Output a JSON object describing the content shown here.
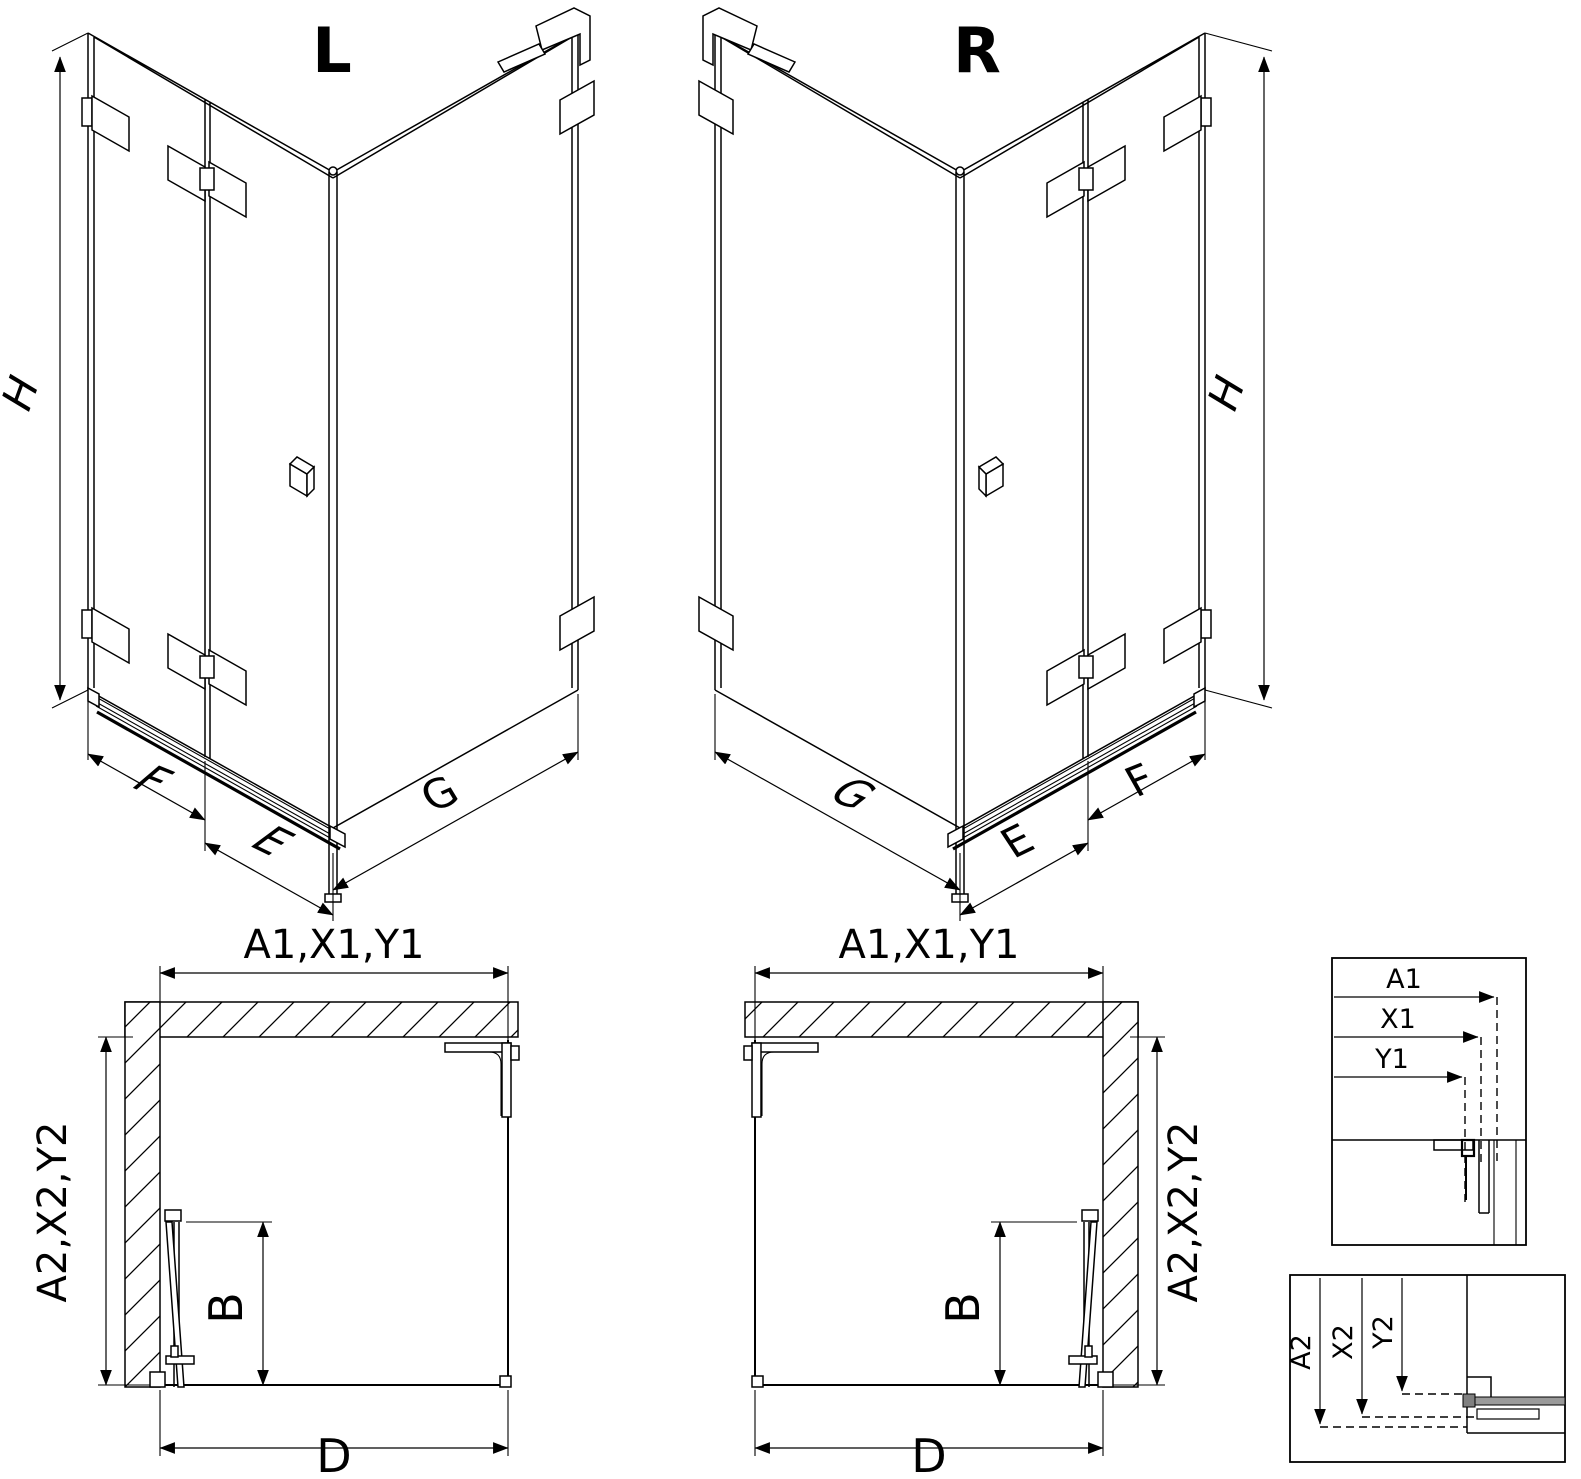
{
  "canvas": {
    "background": "#ffffff",
    "line_color": "#000000",
    "profile_gray": "#9a9a9a"
  },
  "iso_left": {
    "title": "L",
    "dim_height": "H",
    "dim_fixed": "F",
    "dim_door": "E",
    "dim_side": "G"
  },
  "iso_right": {
    "title": "R",
    "dim_height": "H",
    "dim_fixed": "F",
    "dim_door": "E",
    "dim_side": "G"
  },
  "plan_left": {
    "dim_width": "A1,X1,Y1",
    "dim_depth": "A2,X2,Y2",
    "dim_door": "B",
    "dim_base": "D"
  },
  "plan_right": {
    "dim_width": "A1,X1,Y1",
    "dim_depth": "A2,X2,Y2",
    "dim_door": "B",
    "dim_base": "D"
  },
  "detail_width": {
    "a1": "A1",
    "x1": "X1",
    "y1": "Y1"
  },
  "detail_depth": {
    "a2": "A2",
    "x2": "X2",
    "y2": "Y2"
  }
}
